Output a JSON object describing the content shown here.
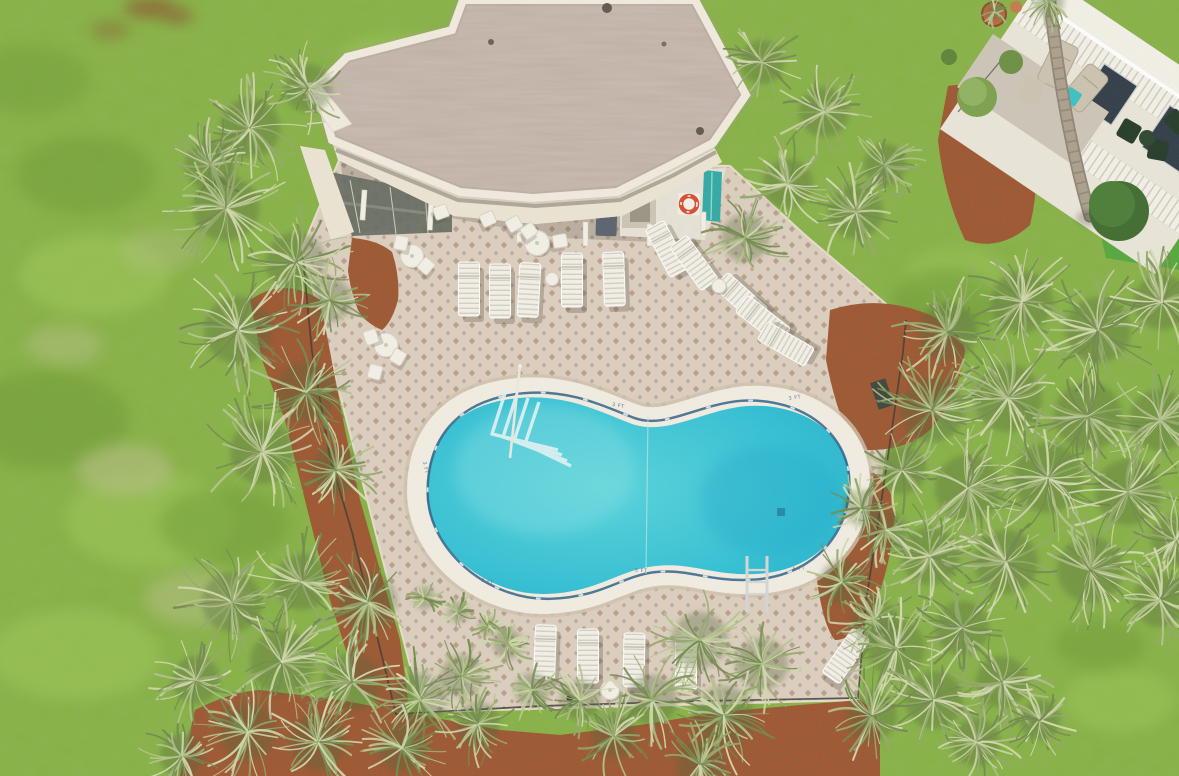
{
  "scene": {
    "alt": "Aerial drone view of a kidney-shaped community pool on a diamond-tiled deck with white lounge chairs, an angular flat-roof clubhouse, palmetto palms, red mulch beds, lawn, and the corner of a condo building with balconies",
    "depth_markers": [
      {
        "x": 618,
        "y": 407,
        "rot": 10,
        "label": "3 FT"
      },
      {
        "x": 795,
        "y": 399,
        "rot": -8,
        "label": "3 FT"
      },
      {
        "x": 487,
        "y": 583,
        "rot": 16,
        "label": "3 FT"
      },
      {
        "x": 641,
        "y": 572,
        "rot": 2,
        "label": "5 FT"
      },
      {
        "x": 799,
        "y": 570,
        "rot": -6,
        "label": "5 FT"
      },
      {
        "x": 424,
        "y": 468,
        "rot": 78,
        "label": "3 FT"
      }
    ]
  },
  "colors": {
    "grass": "#84b140",
    "grassLight": "#9dc957",
    "grassDark": "#699832",
    "grassDry": "#b5bd82",
    "soil": "#8a5f2f",
    "deck": "#dccfc0",
    "deckDiamond": "#b1947d",
    "coping": "#f3eee3",
    "copingShadow": "#cfc2ad",
    "waterLight": "#55d4dc",
    "waterMid": "#33c2d6",
    "waterEdge": "#1ba8c8",
    "waterline": "#2a5e86",
    "roof": "#cbbcb2",
    "parapet": "#f2ece0",
    "fascia": "#ece5d4",
    "sidingLine": "#d0c8b6",
    "wall": "#eae6da",
    "screen": "#646a60",
    "mulch": "#a1522b",
    "fence": "#3b3b32",
    "palm1": "#70894c",
    "palm2": "#93a86a",
    "palm3": "#b3c38b",
    "palm4": "#d2d9ae",
    "palmShadow": "#4f6336",
    "white": "#f4f1e8",
    "slat": "#d3d0c4",
    "binBody": "#58626d",
    "binLid": "#6e7883",
    "lifeRing": "#d84b31",
    "tealDoor": "#2fa9a4",
    "railing": "#f4f1e9",
    "picket": "#cfcabc",
    "windowDark": "#2f3b46",
    "patio": "#cdc5b7",
    "chairTan": "#ccc3b0",
    "chairGreen": "#223a27",
    "tableTeal": "#39c2c4",
    "trunk": "#ab9f8c",
    "trunkDark": "#8f8474",
    "shrubDark": "#3e6b2d",
    "shrubMid": "#4a7c36",
    "shrubOlive": "#7ba04c",
    "turf": "#51a63b",
    "pot": "#b96a3e",
    "ladder": "#d4d8d6",
    "marker": "#5a6b86"
  },
  "palms": [
    [
      250,
      128,
      60
    ],
    [
      308,
      88,
      48
    ],
    [
      210,
      165,
      50
    ],
    [
      226,
      208,
      66
    ],
    [
      296,
      262,
      60
    ],
    [
      238,
      330,
      68
    ],
    [
      306,
      392,
      60
    ],
    [
      262,
      452,
      64
    ],
    [
      336,
      470,
      48
    ],
    [
      330,
      300,
      44
    ],
    [
      762,
      62,
      44
    ],
    [
      824,
      112,
      50
    ],
    [
      788,
      184,
      50
    ],
    [
      856,
      212,
      54
    ],
    [
      745,
      238,
      48
    ],
    [
      885,
      165,
      42
    ],
    [
      948,
      332,
      58
    ],
    [
      1022,
      302,
      62
    ],
    [
      1098,
      330,
      66
    ],
    [
      1162,
      302,
      56
    ],
    [
      932,
      410,
      64
    ],
    [
      1008,
      398,
      68
    ],
    [
      1088,
      416,
      68
    ],
    [
      1160,
      420,
      62
    ],
    [
      968,
      488,
      66
    ],
    [
      1048,
      478,
      70
    ],
    [
      1128,
      492,
      66
    ],
    [
      1176,
      540,
      50
    ],
    [
      930,
      556,
      58
    ],
    [
      1006,
      562,
      64
    ],
    [
      1090,
      570,
      66
    ],
    [
      1160,
      600,
      54
    ],
    [
      902,
      470,
      48
    ],
    [
      886,
      530,
      40
    ],
    [
      862,
      508,
      36
    ],
    [
      842,
      582,
      44
    ],
    [
      874,
      620,
      46
    ],
    [
      896,
      648,
      58
    ],
    [
      962,
      628,
      54
    ],
    [
      934,
      700,
      58
    ],
    [
      1002,
      682,
      52
    ],
    [
      872,
      716,
      50
    ],
    [
      976,
      742,
      48
    ],
    [
      1040,
      720,
      40
    ],
    [
      700,
      640,
      56
    ],
    [
      762,
      664,
      52
    ],
    [
      724,
      716,
      60
    ],
    [
      652,
      700,
      50
    ],
    [
      700,
      764,
      48
    ],
    [
      614,
      736,
      44
    ],
    [
      580,
      700,
      40
    ],
    [
      424,
      598,
      22
    ],
    [
      458,
      612,
      20
    ],
    [
      488,
      626,
      18
    ],
    [
      508,
      644,
      30
    ],
    [
      532,
      690,
      34
    ],
    [
      232,
      602,
      60
    ],
    [
      302,
      582,
      56
    ],
    [
      368,
      602,
      58
    ],
    [
      282,
      662,
      64
    ],
    [
      352,
      682,
      58
    ],
    [
      420,
      700,
      54
    ],
    [
      248,
      732,
      56
    ],
    [
      318,
      742,
      56
    ],
    [
      402,
      748,
      48
    ],
    [
      462,
      676,
      42
    ],
    [
      478,
      724,
      44
    ],
    [
      196,
      680,
      48
    ],
    [
      182,
      756,
      44
    ],
    [
      994,
      12,
      16
    ],
    [
      1049,
      2,
      30
    ]
  ],
  "grass_patches": [
    [
      95,
      275,
      75,
      40,
      "light",
      0.55
    ],
    [
      150,
      520,
      85,
      48,
      "light",
      0.5
    ],
    [
      75,
      655,
      85,
      45,
      "light",
      0.5
    ],
    [
      395,
      60,
      55,
      25,
      "light",
      0.5
    ],
    [
      1120,
      700,
      55,
      32,
      "light",
      0.45
    ],
    [
      955,
      275,
      50,
      28,
      "light",
      0.4
    ],
    [
      45,
      420,
      85,
      50,
      "dark",
      0.5
    ],
    [
      225,
      525,
      65,
      38,
      "dark",
      0.45
    ],
    [
      85,
      175,
      70,
      40,
      "dark",
      0.45
    ],
    [
      945,
      305,
      55,
      35,
      "dark",
      0.5
    ],
    [
      1100,
      645,
      45,
      26,
      "dark",
      0.45
    ],
    [
      30,
      80,
      60,
      35,
      "dark",
      0.4
    ],
    [
      125,
      470,
      48,
      26,
      "dry",
      0.6
    ],
    [
      195,
      598,
      50,
      28,
      "dry",
      0.55
    ],
    [
      65,
      345,
      38,
      20,
      "dry",
      0.5
    ],
    [
      160,
      250,
      40,
      22,
      "dry",
      0.4
    ],
    [
      150,
      8,
      26,
      10,
      "soil",
      0.8
    ],
    [
      178,
      16,
      16,
      8,
      "soil",
      0.7
    ],
    [
      110,
      30,
      20,
      9,
      "soil",
      0.5
    ]
  ],
  "loungers": [
    [
      469,
      289,
      0
    ],
    [
      500,
      291,
      0
    ],
    [
      529,
      290,
      3
    ],
    [
      572,
      280,
      0
    ],
    [
      614,
      279,
      -2
    ],
    [
      667,
      249,
      -28
    ],
    [
      694,
      263,
      -36
    ],
    [
      741,
      298,
      -48
    ],
    [
      763,
      320,
      -52
    ],
    [
      786,
      344,
      -60
    ],
    [
      545,
      652,
      2
    ],
    [
      588,
      656,
      0
    ],
    [
      634,
      660,
      1
    ],
    [
      686,
      663,
      0
    ],
    [
      846,
      656,
      35
    ]
  ],
  "tables": [
    [
      412,
      256,
      23
    ],
    [
      386,
      345,
      24
    ],
    [
      537,
      243,
      25
    ],
    [
      610,
      690,
      19
    ]
  ],
  "side_tables": [
    [
      552,
      279,
      13
    ],
    [
      719,
      286,
      14
    ]
  ],
  "chairs": [
    [
      401,
      243,
      12
    ],
    [
      426,
      266,
      40
    ],
    [
      371,
      337,
      -20
    ],
    [
      398,
      357,
      30
    ],
    [
      560,
      241,
      80
    ],
    [
      514,
      224,
      60
    ],
    [
      529,
      231,
      55
    ],
    [
      375,
      372,
      15
    ],
    [
      441,
      212,
      70
    ],
    [
      488,
      219,
      65
    ]
  ]
}
